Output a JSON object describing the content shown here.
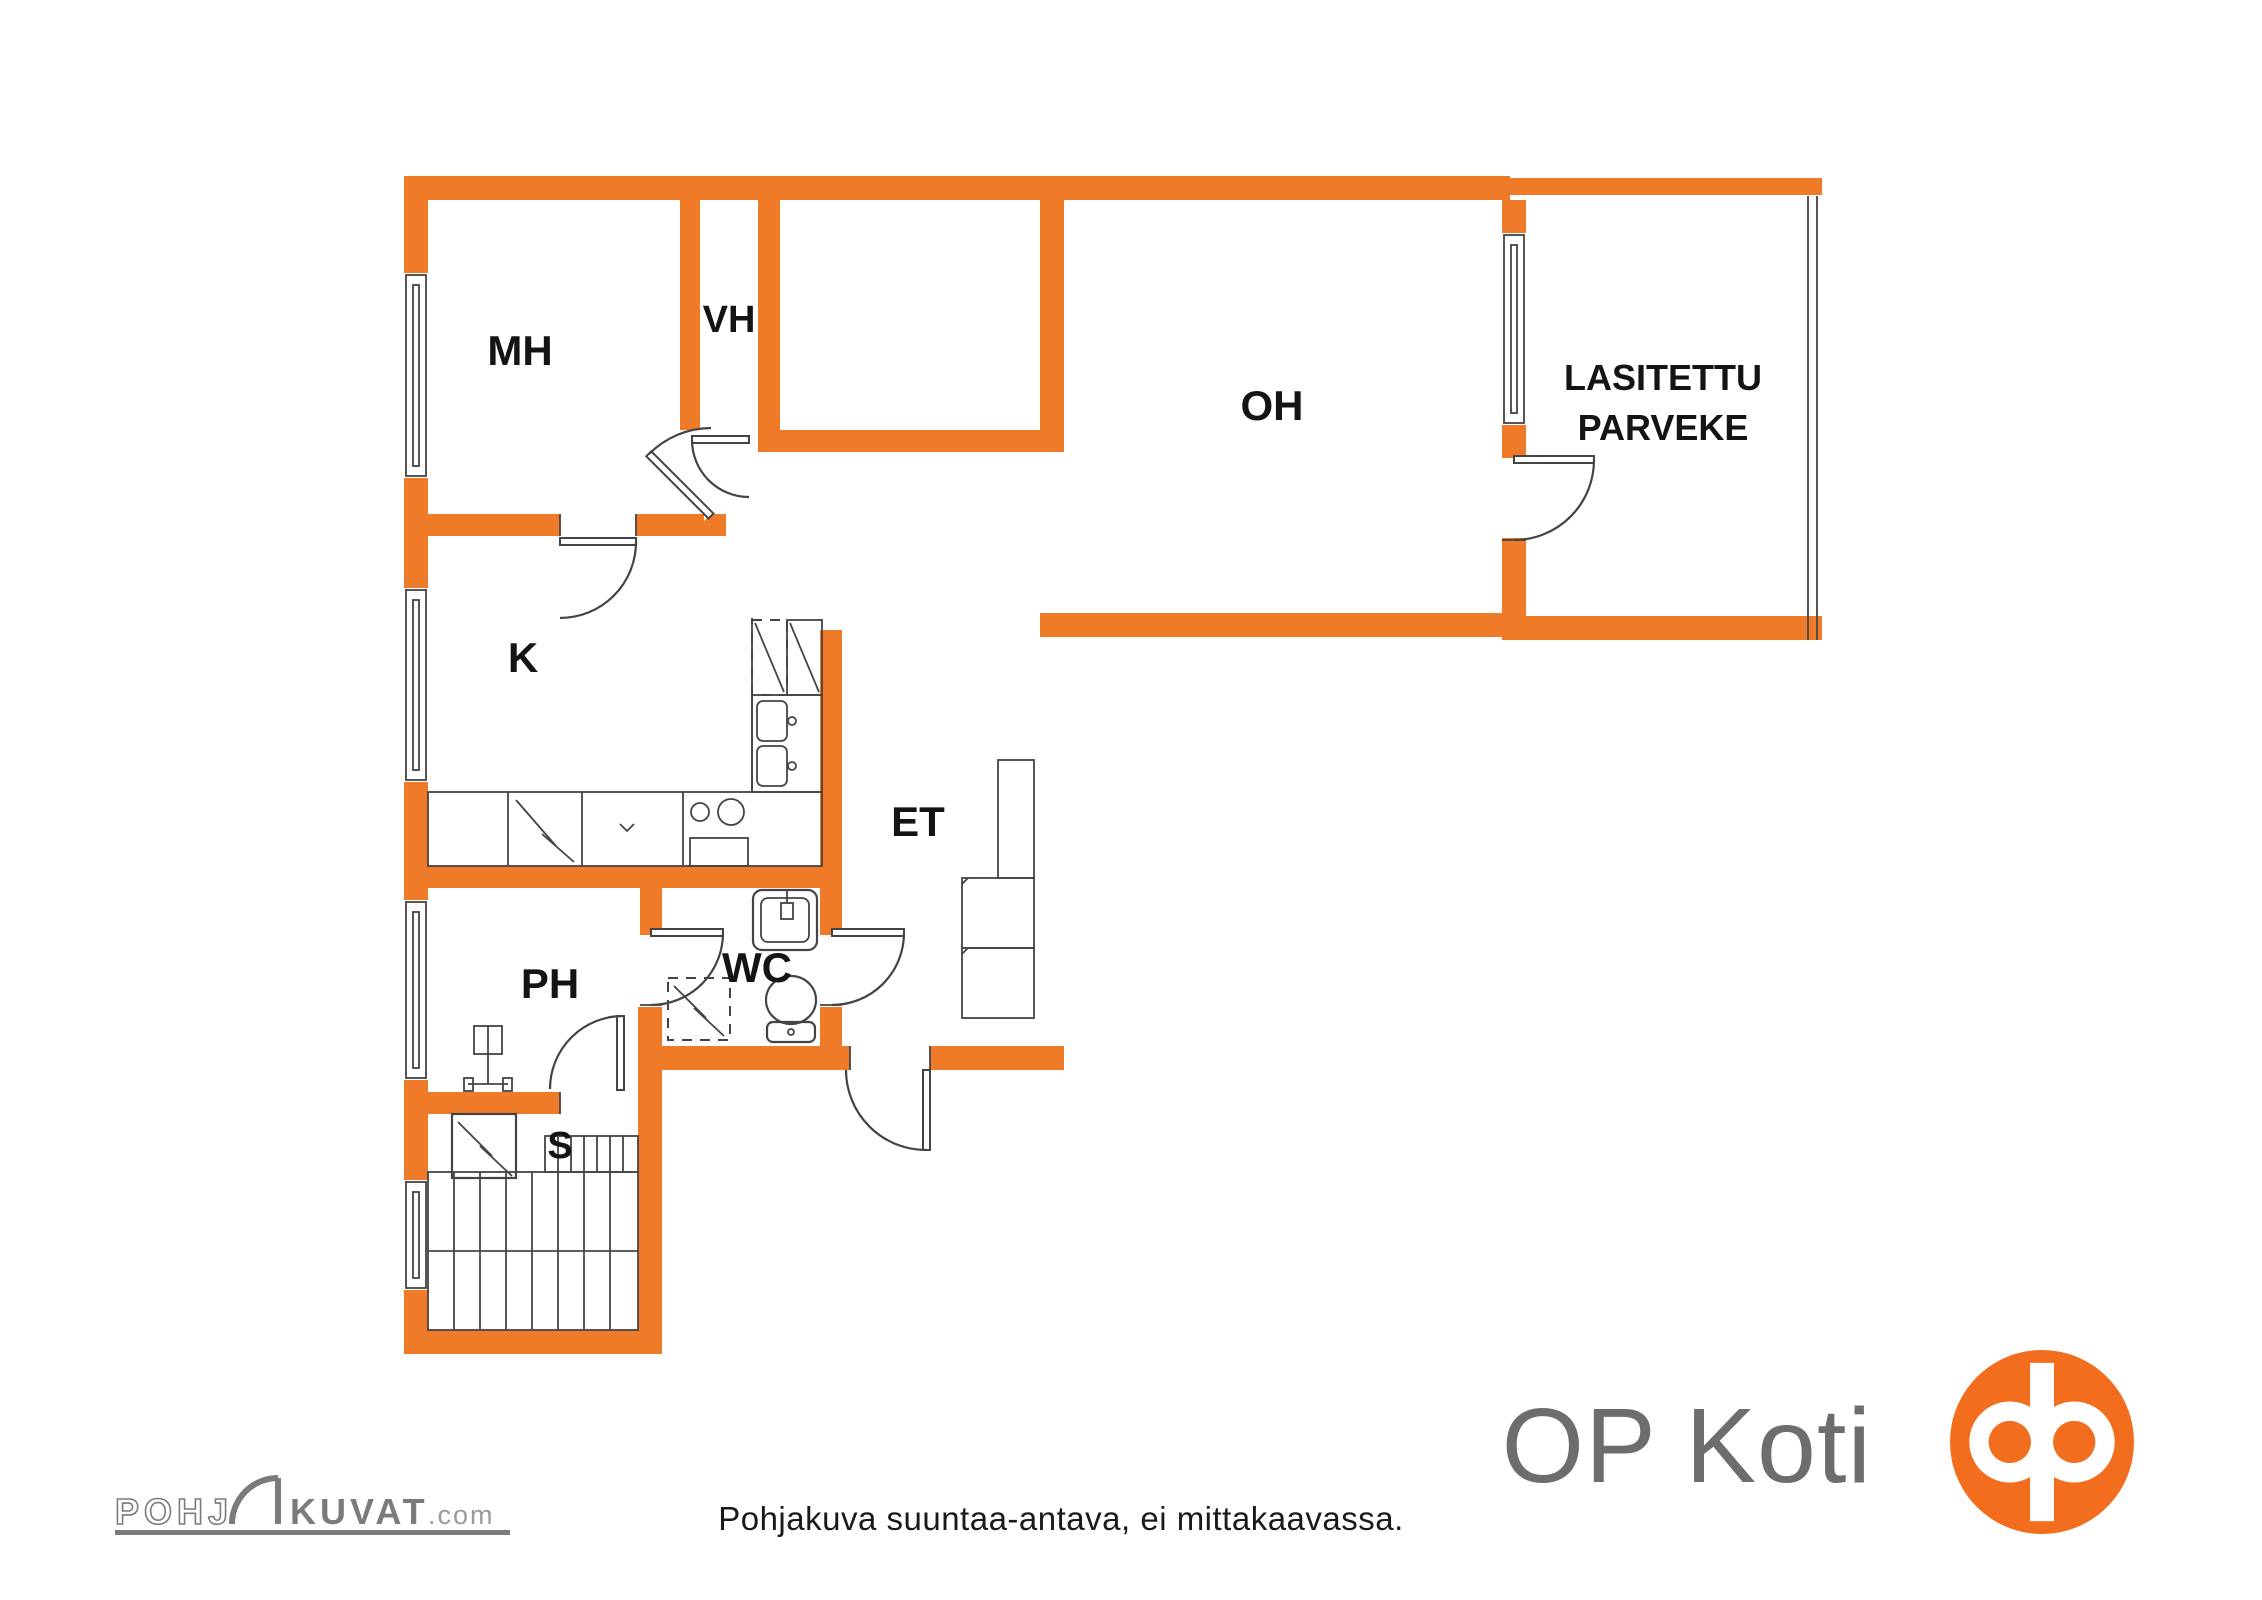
{
  "floor_plan": {
    "wall_color": "#EF7A28",
    "rooms": [
      {
        "id": "mh",
        "label": "MH"
      },
      {
        "id": "vh",
        "label": "VH"
      },
      {
        "id": "oh",
        "label": "OH"
      },
      {
        "id": "parveke",
        "label_line1": "LASITETTU",
        "label_line2": "PARVEKE"
      },
      {
        "id": "k",
        "label": "K"
      },
      {
        "id": "et",
        "label": "ET"
      },
      {
        "id": "wc",
        "label": "WC"
      },
      {
        "id": "ph",
        "label": "PH"
      },
      {
        "id": "s",
        "label": "S"
      }
    ]
  },
  "footer": {
    "disclaimer": "Pohjakuva suuntaa-antava, ei mittakaavassa.",
    "brand": {
      "name": "OP Koti",
      "text_color": "#6d6d6d",
      "logo_color": "#F26E1E"
    },
    "watermark": {
      "part1": "POHJ",
      "part2": "KUVAT",
      "suffix": ".com",
      "color": "#7b7b7b"
    }
  }
}
